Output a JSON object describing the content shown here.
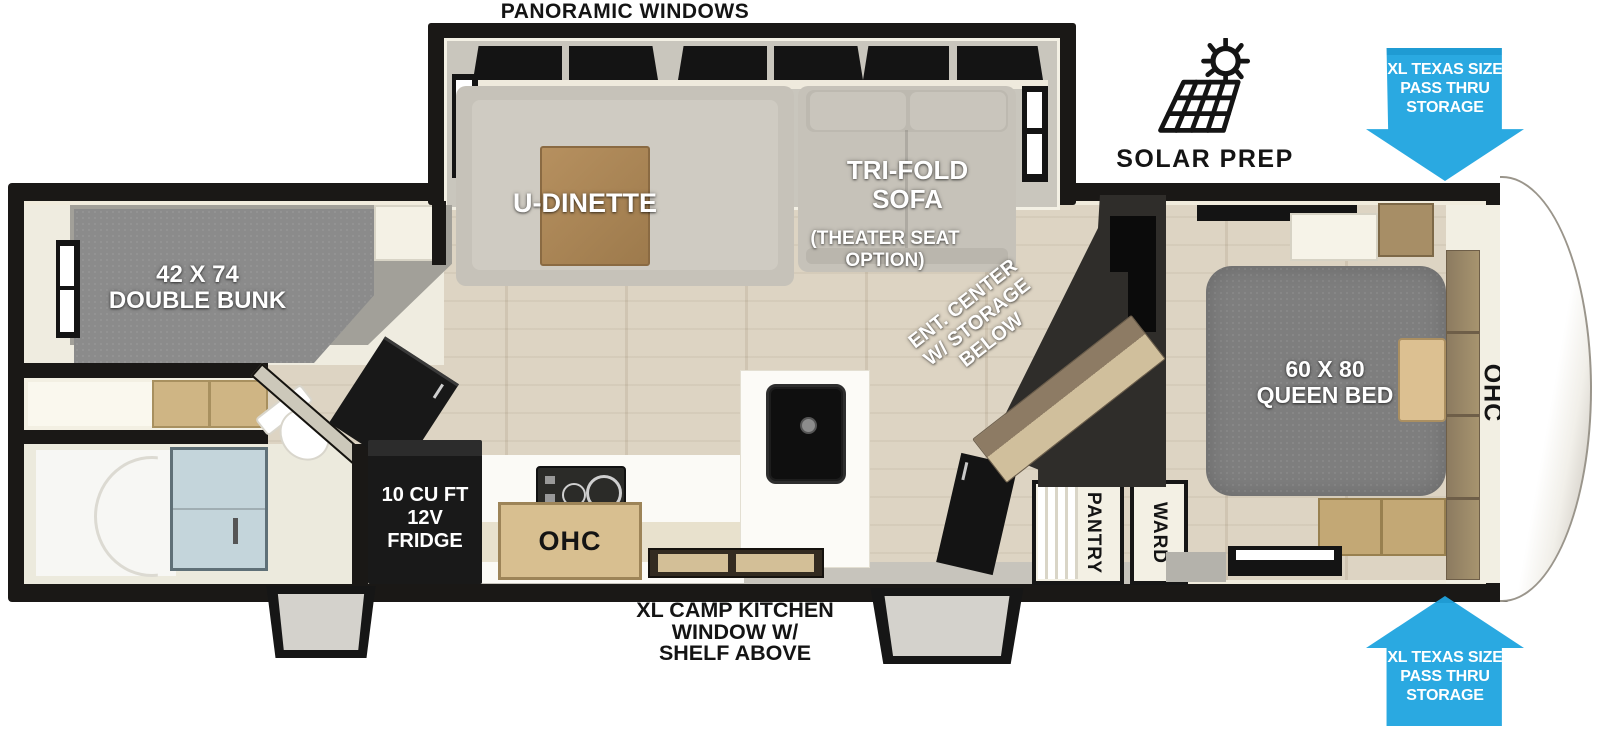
{
  "exterior": {
    "panoramic_windows": "PANORAMIC WINDOWS",
    "solar_prep": "SOLAR PREP",
    "pass_thru_storage": [
      "XL TEXAS SIZE",
      "PASS THRU",
      "STORAGE"
    ],
    "camp_kitchen": [
      "XL CAMP KITCHEN",
      "WINDOW W/",
      "SHELF ABOVE"
    ]
  },
  "living_area": {
    "dinette_label": "U-DINETTE",
    "sofa_label": [
      "TRI-FOLD",
      "SOFA"
    ],
    "sofa_option": [
      "(THEATER SEAT",
      "OPTION)"
    ],
    "ent_center": [
      "ENT. CENTER",
      "W/ STORAGE",
      "BELOW"
    ]
  },
  "bunk_room": {
    "double_bunk": [
      "42 X 74",
      "DOUBLE BUNK"
    ]
  },
  "bedroom": {
    "queen_bed": [
      "60 X 80",
      "QUEEN BED"
    ],
    "overhead_cabinet": "OHC"
  },
  "kitchen": {
    "overhead_cabinet": "OHC",
    "fridge": [
      "10 CU FT",
      "12V",
      "FRIDGE"
    ],
    "pantry": "PANTRY",
    "wardrobe": "WARD"
  },
  "colors": {
    "arrow_blue": "#2aa9e1",
    "wall_black": "#1a1816",
    "floor_wood": "#ddd4c3",
    "mattress_gray": "#8b8b8b",
    "cabinet_wood": "#b08d5f",
    "shower_glass": "#c4d5db",
    "charcoal_wall": "#2f2d2a"
  }
}
